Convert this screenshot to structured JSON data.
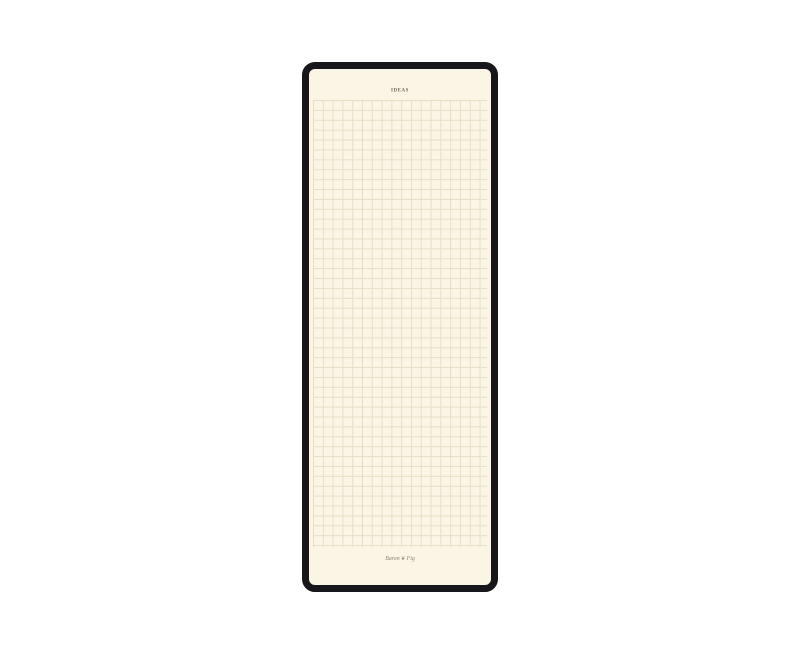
{
  "window": {
    "width_px": 800,
    "height_px": 655,
    "description": "Tall narrow cream graph-paper notepad with thick black rounded frame, centered on white background"
  },
  "notepad": {
    "title": "IDEAS",
    "brand": {
      "word_left": "Baron",
      "ornament": "❦",
      "word_right": "Fig"
    },
    "grid": {
      "type": "square-graph",
      "cell_size_px": 10,
      "columns": 18,
      "rows": 45
    },
    "colors": {
      "paper": "#FAF5E5",
      "border": "#17171B",
      "grid_line": "#E7DEC6",
      "title_text": "#6E685A",
      "logo_text": "#8B8472",
      "page_bg": "#FFFFFF"
    }
  }
}
